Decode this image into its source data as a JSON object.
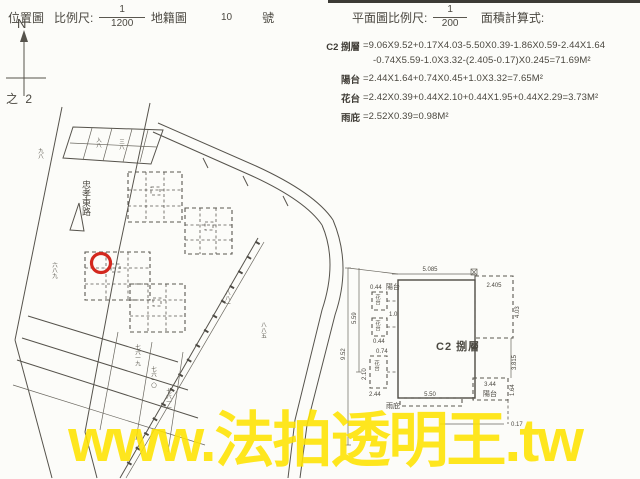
{
  "page": {
    "watermark": "www.法拍透明王.tw",
    "watermark_color": "#ffe400",
    "paper_color": "#fcfcf9",
    "ink_color": "#56534c",
    "red_marker_color": "#d3281e"
  },
  "location_header": {
    "title": "位置圖",
    "scale_label": "比例尺:",
    "scale_numerator": "1",
    "scale_denominator": "1200",
    "map_type": "地籍圖",
    "sheet_number": "10",
    "sheet_unit": "號",
    "north_label": "N",
    "page_note": "之 2"
  },
  "plan_header": {
    "scale_label": "平面圖比例尺:",
    "scale_numerator": "1",
    "scale_denominator": "200",
    "calc_label": "面積計算式:"
  },
  "area_calculations": [
    {
      "label": "C2 捌層",
      "lines": [
        "=9.06X9.52+0.17X4.03-5.50X0.39-1.86X0.59-2.44X1.64",
        "-0.74X5.59-1.0X3.32-(2.405-0.17)X0.245=71.69M²"
      ]
    },
    {
      "label": "陽台",
      "lines": [
        "=2.44X1.64+0.74X0.45+1.0X3.32=7.65M²"
      ]
    },
    {
      "label": "花台",
      "lines": [
        "=2.42X0.39+0.44X2.10+0.44X1.95+0.44X2.29=3.73M²"
      ]
    },
    {
      "label": "雨庇",
      "lines": [
        "=2.52X0.39=0.98M²"
      ]
    }
  ],
  "site_plan": {
    "road_name": "忠孝東路",
    "lot_labels": [
      "六八九",
      "八八一",
      "八八五",
      "七六一九",
      "七六一〇",
      "七六一一",
      "九八",
      "入八",
      "三八"
    ]
  },
  "floor_plan": {
    "unit_label": "C2 捌層",
    "balcony_label": "陽台",
    "balcony_label_br": "陽台",
    "flower_label_1": "花台",
    "flower_label_2": "花台",
    "flower_label_3": "花台",
    "canopy_label": "雨庇",
    "dim_top": "5.085",
    "dim_top_right": "2.405",
    "dim_right_upper": "4.03",
    "dim_right_mid": "3.815",
    "dim_right_lower": "1.64",
    "dim_balcony_width": "3.44",
    "dim_bottom": "5.50",
    "dim_bottom_right": "0.17",
    "dim_left_total": "9.52",
    "dim_left_upper": "5.59",
    "dim_tl_1": "0.44",
    "dim_tl_2": "1.0",
    "dim_tl_3": "0.44",
    "dim_tl_4": "0.74",
    "dim_tl_5": "2.10",
    "dim_tl_6": "2.44"
  }
}
